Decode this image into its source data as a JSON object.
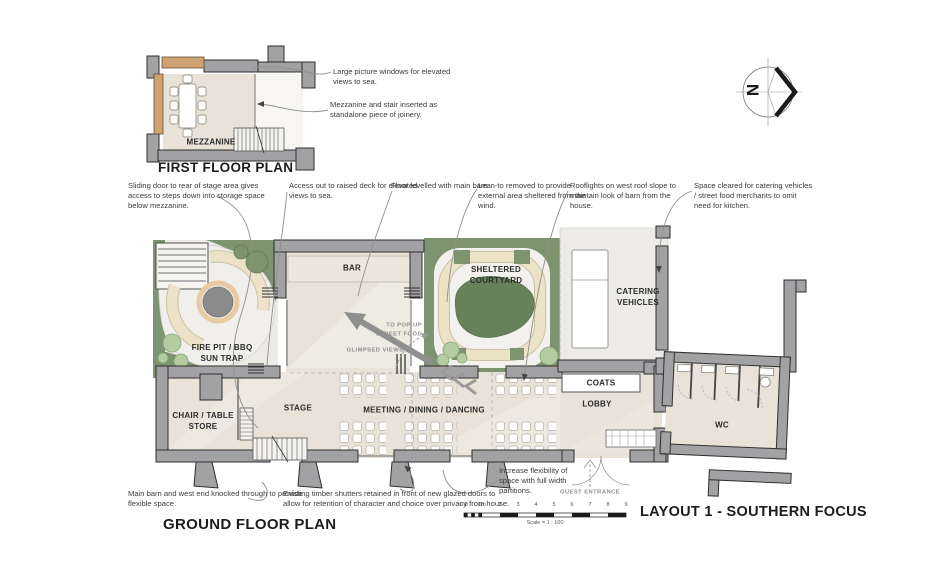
{
  "titles": {
    "first_floor": "FIRST FLOOR PLAN",
    "ground_floor": "GROUND FLOOR PLAN",
    "layout": "LAYOUT 1  - SOUTHERN FOCUS"
  },
  "compass": {
    "north_label": "N"
  },
  "rooms": {
    "mezzanine": "MEZZANINE",
    "bar": "BAR",
    "sheltered_courtyard": "SHELTERED\nCOURTYARD",
    "catering_vehicles": "CATERING\nVEHICLES",
    "fire_pit": "FIRE PIT / BBQ\nSUN TRAP",
    "chair_store": "CHAIR / TABLE\nSTORE",
    "stage": "STAGE",
    "meeting": "MEETING / DINING / DANCING",
    "coats": "COATS",
    "lobby": "LOBBY",
    "wc": "WC"
  },
  "site_notes": {
    "pop_up_street_food": "TO POP-UP\nSTREET FOOD",
    "glimpsed_views": "GLIMPSED VIEWS",
    "guest_entrance": "GUEST ENTRANCE"
  },
  "annotations": {
    "large_windows": "Large picture windows for elevated views to sea.",
    "mezzanine_joinery": "Mezzanine and stair inserted as standalone piece of joinery.",
    "sliding_door": "Sliding door to rear of stage area gives access to steps down into storage space below mezzanine.",
    "access_deck": "Access out to raised deck for elevated views to sea.",
    "floor_levelled": "Floor levelled with main barn.",
    "lean_to": "Lean-to removed to provide external area sheltered from the wind.",
    "rooflights": "Rooflights on west roof slope to maintain look of barn from the house.",
    "space_cleared": "Space cleared for catering vehicles / street food merchants to omit need for kitchen.",
    "increase_flex": "Increase flexibility of space with full width partitions.",
    "main_barn": "Main barn and west end knocked through to provide flexible space.",
    "shutters": "Existing timber shutters retained in front of new glazed doors to allow for retention of character and choice over privacy from house."
  },
  "scale_bar": {
    "ticks": [
      "0.0",
      "1m",
      "2",
      "3",
      "4",
      "5",
      "6",
      "7",
      "8",
      "9"
    ],
    "caption": "Scale = 1 : 100"
  },
  "colors": {
    "wall": "#a2a2a4",
    "interior_floor": "#e8e2d8",
    "pavement": "#ecebe7",
    "landscape_green": "#7e9471",
    "shrub_green": "#b3cda1",
    "bench_cream": "#ebe2c7",
    "timber": "#cfa273",
    "fire_pit_ring": "#e9c9a2",
    "ink": "#2b2b2b"
  }
}
